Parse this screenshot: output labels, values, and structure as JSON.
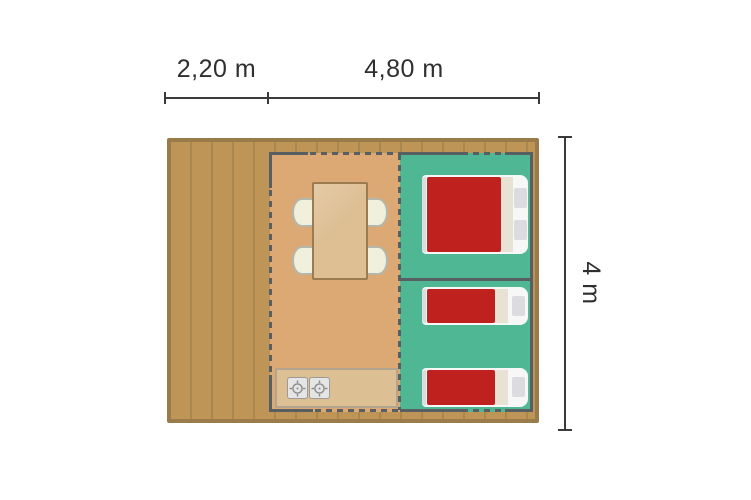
{
  "dimensions": {
    "terrace_width_label": "2,20 m",
    "interior_width_label": "4,80 m",
    "depth_label": "4 m"
  },
  "plan": {
    "areas": [
      "terrace-deck",
      "living-area",
      "kitchen",
      "bedroom-double",
      "bedroom-twin"
    ],
    "furniture": {
      "dining_table": 1,
      "chairs": 4,
      "stove_burners": 2,
      "double_beds": 1,
      "single_beds": 2
    },
    "icons": [
      "stove-burner-icon"
    ]
  },
  "colors": {
    "deck": "#bf9457",
    "deck-line": "#aa874e",
    "deck-border": "#9a7c4a",
    "floor": "#dca873",
    "bedroom": "#4fb794",
    "wall": "#575f63",
    "table": "#debf94",
    "table-border": "#9c7b50",
    "chair": "#f1f0dd",
    "chair-border": "#b4b8ac",
    "counter": "#ddbf94",
    "counter-border": "#b3a58d",
    "burner": "#e5e5e5",
    "burner-border": "#9b9b9b",
    "bed-red": "#bf211e",
    "mattress": "#f7f7f7",
    "bed-fold": "#e8e2d4",
    "pillow": "#dcdce0",
    "dim-line": "#3a3a3a",
    "dim-text": "#2f2f2f"
  }
}
